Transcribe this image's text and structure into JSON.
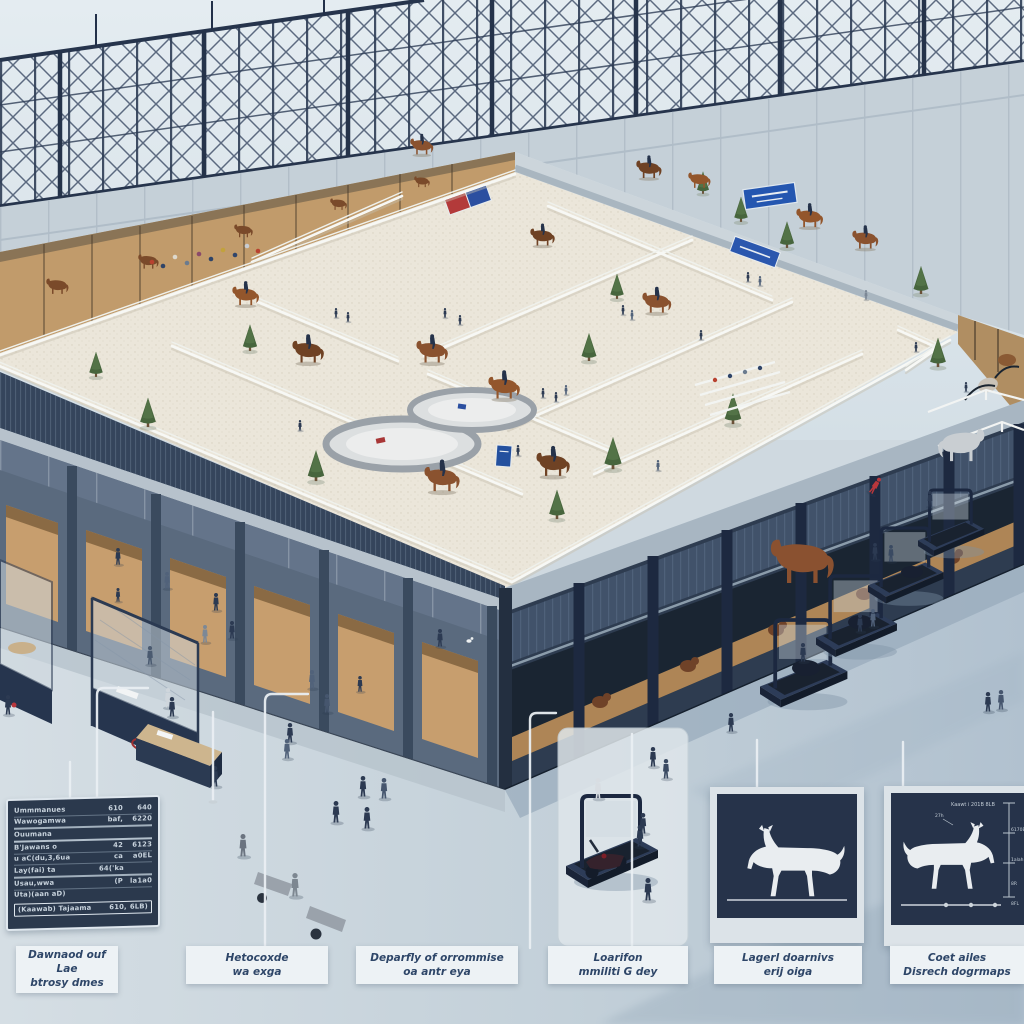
{
  "scene": {
    "description": "Isometric 3D overview of an indoor equestrian arena with steel truss roof, rooftop dressage paddocks, stables, visitors, exercise treadmills and annotated exhibit panels"
  },
  "callout_labels": [
    {
      "line1": "Dawnaod ouf Lae",
      "line2": "btrosy dmes"
    },
    {
      "line1": "Hetocoxde",
      "line2": "wa exga"
    },
    {
      "line1": "Deparfly of orrommise",
      "line2": "oa antr eya"
    },
    {
      "line1": "Loarifon",
      "line2": "mmiliti G dey"
    },
    {
      "line1": "Lagerl doarnivs",
      "line2": "erij oiga"
    },
    {
      "line1": "Coet ailes",
      "line2": "Disrech dogrmaps"
    }
  ],
  "info_board": {
    "rows": [
      {
        "label": "Ummmanues",
        "v1": "610",
        "v2": "640"
      },
      {
        "label": "Wawogamwa",
        "v1": "baf,",
        "v2": "6220"
      },
      {
        "label": "Ouumana",
        "v1": "",
        "v2": ""
      },
      {
        "label": "B'Jawans o",
        "v1": "42",
        "v2": "6123"
      },
      {
        "label": "u aC(du,3,6ua",
        "v1": "ca",
        "v2": "a0EL"
      },
      {
        "label": "Lay(fai) ta",
        "v1": "64('ka",
        "v2": ""
      },
      {
        "label": "Usau,wwa",
        "v1": "(P",
        "v2": "la1a0"
      },
      {
        "label": "Uta)(aan aD)",
        "v1": "",
        "v2": ""
      }
    ],
    "footer": {
      "label": "(Kaawab) Tajaama",
      "v1": "610,",
      "v2": "6LB)"
    }
  },
  "measure_panel": {
    "top_label": "Kaawt i 201B 8LB",
    "ticks": [
      "6170B",
      "1alah",
      "8R"
    ],
    "bottom_tick": "8FL",
    "head_label": "27h"
  },
  "colors": {
    "steel": "#2a3850",
    "wall_panel": "#c5d0d8",
    "arena_sand": "#ebe6da",
    "facade_right": "#2e3c50",
    "facade_left": "#5a6a7e",
    "ground_left": "#d5dee4",
    "ground_right": "#b1c1cf",
    "panel_navy": "#26334a",
    "accent_blue": "#2b57ae",
    "accent_red": "#b33a3a",
    "label_text": "#2e4668"
  }
}
